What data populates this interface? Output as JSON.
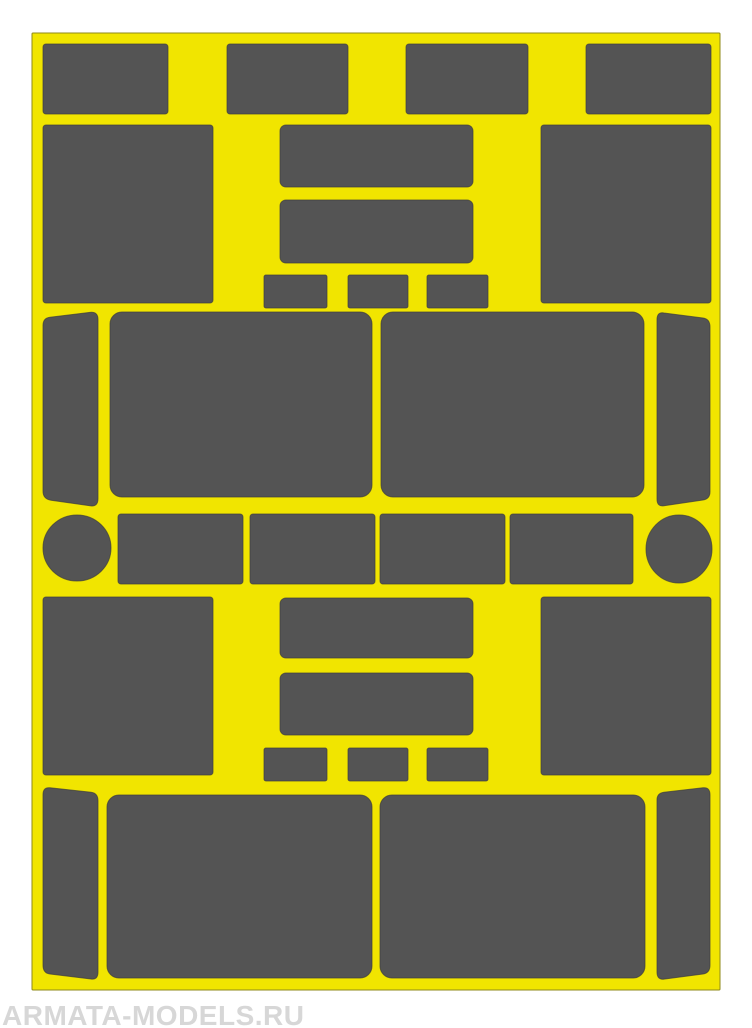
{
  "page": {
    "background": "#ffffff",
    "width": 752,
    "height": 1028
  },
  "watermark": {
    "text": "ARMATA-MODELS.RU",
    "color": "#d7d7d7"
  },
  "sheet": {
    "fill": "#f1e500",
    "outline": "#8f8a1a",
    "shape_fill": "#545454",
    "shape_outline": "#3c3c3c",
    "base": {
      "type": "rect",
      "name": "sheet-base",
      "x": 32,
      "y": 33,
      "w": 688,
      "h": 957,
      "rx": 1
    },
    "shapes": [
      {
        "type": "rect",
        "name": "top-row-rect-1",
        "x": 43,
        "y": 44,
        "w": 125,
        "h": 70,
        "rx": 3
      },
      {
        "type": "rect",
        "name": "top-row-rect-2",
        "x": 227,
        "y": 44,
        "w": 121,
        "h": 70,
        "rx": 3
      },
      {
        "type": "rect",
        "name": "top-row-rect-3",
        "x": 406,
        "y": 44,
        "w": 122,
        "h": 70,
        "rx": 3
      },
      {
        "type": "rect",
        "name": "top-row-rect-4",
        "x": 586,
        "y": 44,
        "w": 125,
        "h": 70,
        "rx": 3
      },
      {
        "type": "rect",
        "name": "upper-left-panel",
        "x": 43,
        "y": 125,
        "w": 170,
        "h": 178,
        "rx": 3
      },
      {
        "type": "rect",
        "name": "upper-right-panel",
        "x": 541,
        "y": 125,
        "w": 170,
        "h": 178,
        "rx": 3
      },
      {
        "type": "rect",
        "name": "upper-center-band-1",
        "x": 280,
        "y": 125,
        "w": 193,
        "h": 62,
        "rx": 6
      },
      {
        "type": "rect",
        "name": "upper-center-band-2",
        "x": 280,
        "y": 200,
        "w": 193,
        "h": 63,
        "rx": 6
      },
      {
        "type": "rect",
        "name": "upper-small-square-1",
        "x": 264,
        "y": 275,
        "w": 63,
        "h": 33,
        "rx": 2
      },
      {
        "type": "rect",
        "name": "upper-small-square-2",
        "x": 348,
        "y": 275,
        "w": 60,
        "h": 33,
        "rx": 2
      },
      {
        "type": "rect",
        "name": "upper-small-square-3",
        "x": 427,
        "y": 275,
        "w": 61,
        "h": 33,
        "rx": 2
      },
      {
        "type": "path",
        "name": "mid-left-strip",
        "d": "M 50 317.2 L 90 312.4 Q 98 311.5 98 319.5 L 98 498.5 Q 98 507 90 505.8 L 51 500.2 Q 43 499 43 491 L 43 325.5 Q 43 318 50 317.2 Z"
      },
      {
        "type": "rect",
        "name": "mid-window-left",
        "x": 110,
        "y": 312,
        "w": 262,
        "h": 185,
        "rx": 12
      },
      {
        "type": "rect",
        "name": "mid-window-right",
        "x": 381,
        "y": 312,
        "w": 263,
        "h": 185,
        "rx": 12
      },
      {
        "type": "path",
        "name": "mid-right-strip",
        "d": "M 664 313 L 703 318 Q 710 319 710 327 L 710 491.5 Q 710 499 703 500 L 664 505.7 Q 657 507 657 499 L 657 319.8 Q 657 311.6 664 313 Z"
      },
      {
        "type": "ellipse",
        "name": "left-disc",
        "cx": 77,
        "cy": 548,
        "rx": 34,
        "ry": 33
      },
      {
        "type": "rect",
        "name": "mid-row-rect-1",
        "x": 118,
        "y": 514,
        "w": 125,
        "h": 70,
        "rx": 3
      },
      {
        "type": "rect",
        "name": "mid-row-rect-2",
        "x": 250,
        "y": 514,
        "w": 125,
        "h": 70,
        "rx": 3
      },
      {
        "type": "rect",
        "name": "mid-row-rect-3",
        "x": 380,
        "y": 514,
        "w": 125,
        "h": 70,
        "rx": 3
      },
      {
        "type": "rect",
        "name": "mid-row-rect-4",
        "x": 510,
        "y": 514,
        "w": 123,
        "h": 70,
        "rx": 3
      },
      {
        "type": "ellipse",
        "name": "right-disc",
        "cx": 679,
        "cy": 549,
        "rx": 33,
        "ry": 34
      },
      {
        "type": "rect",
        "name": "lower-left-panel",
        "x": 43,
        "y": 597,
        "w": 170,
        "h": 178,
        "rx": 3
      },
      {
        "type": "rect",
        "name": "lower-right-panel",
        "x": 541,
        "y": 597,
        "w": 170,
        "h": 178,
        "rx": 3
      },
      {
        "type": "rect",
        "name": "lower-center-band-1",
        "x": 280,
        "y": 598,
        "w": 193,
        "h": 60,
        "rx": 6
      },
      {
        "type": "rect",
        "name": "lower-center-band-2",
        "x": 280,
        "y": 673,
        "w": 193,
        "h": 62,
        "rx": 6
      },
      {
        "type": "rect",
        "name": "lower-small-square-1",
        "x": 264,
        "y": 748,
        "w": 63,
        "h": 33,
        "rx": 2
      },
      {
        "type": "rect",
        "name": "lower-small-square-2",
        "x": 348,
        "y": 748,
        "w": 60,
        "h": 33,
        "rx": 2
      },
      {
        "type": "rect",
        "name": "lower-small-square-3",
        "x": 427,
        "y": 748,
        "w": 61,
        "h": 33,
        "rx": 2
      },
      {
        "type": "path",
        "name": "bottom-left-strip",
        "d": "M 50 787.8 L 91 792.2 Q 98 793 98 801 L 98 972 Q 98 980 91 979 L 50 974 Q 43 973.2 43 965 L 43 795 Q 43 786.9 50 787.8 Z"
      },
      {
        "type": "rect",
        "name": "bottom-window-left",
        "x": 107,
        "y": 795,
        "w": 265,
        "h": 183,
        "rx": 12
      },
      {
        "type": "rect",
        "name": "bottom-window-right",
        "x": 380,
        "y": 795,
        "w": 265,
        "h": 183,
        "rx": 12
      },
      {
        "type": "path",
        "name": "bottom-right-strip",
        "d": "M 664 792.2 L 703 787.8 Q 710 787 710 795 L 710 965 Q 710 973 703 974 L 664 979.1 Q 657 980 657 972 L 657 800 Q 657 793.1 664 792.2 Z"
      }
    ]
  }
}
